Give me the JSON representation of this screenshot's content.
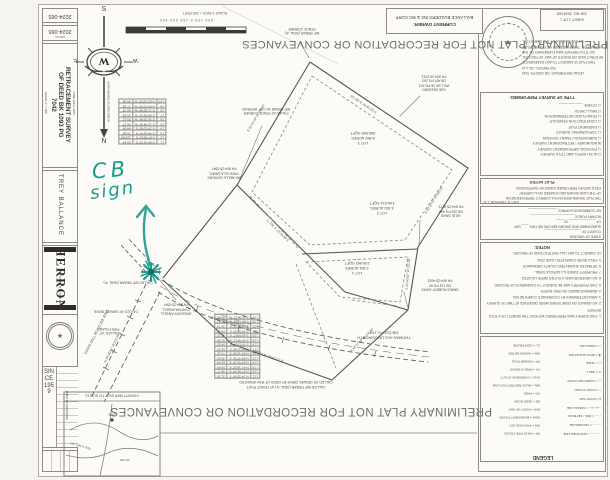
{
  "watermark": {
    "text": "PRELIMINARY PLAT NOT FOR RECORDATION OR CONVEYANCES"
  },
  "annotation": {
    "text_line1": "CB",
    "text_line2": "sign",
    "color": "#1b9b8c"
  },
  "owner": {
    "label": "CURRENT OWNER:",
    "name": "BALLANCE BUILDERS INC & WC CORP"
  },
  "titleblock": {
    "job_number": "2024-065",
    "job_label": "JOB NO.",
    "title_lines": [
      "RETRACEMENT SURVEY",
      "OF DEED BK 1093 PG",
      "7042"
    ],
    "scale_note": "SCALE: 1\" = 200'",
    "date_note": "JUNE 10TH, 2024",
    "client": "TREY BALLANCE",
    "firm": "HERRON",
    "firm_sub": "LAND SURVEYING",
    "since": "SINCE 1959",
    "revisions_heading": "TABLE OF REVISIONS",
    "seal_center": "★"
  },
  "compass": {
    "n": "N",
    "s": "S",
    "e": "E",
    "w": "W",
    "monogram": "W",
    "note": "NORTH BASED ON GRID NORTH"
  },
  "scalebar": {
    "caption": "SCALE 1 INCH = 200 FEET",
    "ticks": "200   100   0   100   200   400"
  },
  "stamp": {
    "center": "★"
  },
  "plat": {
    "lots": {
      "lot1": [
        "LOT 1",
        "2.501 ACRES",
        "108,963 SQFT"
      ],
      "lot2": [
        "LOT 2",
        "3.352 ACRES",
        "146,014 SQFT"
      ],
      "lot3": [
        "LOT 3",
        "8.852 ACRES",
        "385,598 SQFT"
      ]
    },
    "adjoiners": {
      "baldwin": [
        "SUE BALDWIN",
        "WILL BK 28 PG 202",
        "DB 467 PG 203",
        "PH 804-25-2013"
      ],
      "julie": [
        "JULIE DAVIS",
        "DB 318 PG 440",
        "PH 804-25-3173"
      ],
      "james": [
        "JAMES ROBERT DAVIS",
        "DB 132 PG 60",
        "PH 804-25-4031"
      ],
      "thomas": [
        "THOMAS HOLLINGSWORTH",
        "DB 610 PG 143"
      ],
      "ansell": [
        "GREGORY ANSELL",
        "CYNTHIA ANSELL",
        "PH 804-25-0547"
      ],
      "sowers": [
        "MICHELLE SOWERS",
        "PRISCILLA SAVES",
        "PH 804-25-0547"
      ]
    },
    "corners": {
      "fence": [
        "5/8\" REBAR (SEAL 'A')",
        "FENCE CORNER"
      ],
      "cap": [
        "FOUND AT FENCE CORNER",
        "5/8\" REBAR W/ CAP 'HERRON'"
      ],
      "called_rebar": "CALLED 5/8\" REBAR (SEAL 'A')",
      "called_drive": "CALLED 40' GRAVEL DRIVE",
      "pipe": [
        "CALLED 1/2\"",
        "PIPE FOUND"
      ]
    },
    "roads": {
      "name": "DAVIS MILL ROAD (50' R/W)",
      "drive": "EXISTING GRAVEL DRIVE"
    },
    "bearings": [
      "S 53°18'40\" E  387.55'",
      "S 30°51'10\" W  245.20'",
      "S 45°02'27\" E  301.77'",
      "S 32°20'15\" W  162.05'",
      "S 03°40'52\" W  122.18'",
      "S 44°57'38\" W  170.93'",
      "N 72°25'48\" W  208.60'",
      "N 28°40'11\" W  132.60'"
    ],
    "table_a": {
      "rows": [
        [
          "L1",
          "N 86°41'22\" E",
          "50.44'"
        ],
        [
          "L2",
          "S 67°09'51\" E",
          "120.09'"
        ],
        [
          "L3",
          "S 48°33'47\" E",
          "75.60'"
        ],
        [
          "L4",
          "S 29°10'05\" E",
          "64.05'"
        ],
        [
          "L5",
          "S 12°44'30\" W",
          "88.27'"
        ],
        [
          "L6",
          "S 35°28'56\" W",
          "55.11'"
        ],
        [
          "L7",
          "S 58°02'14\" W",
          "92.83'"
        ],
        [
          "L8",
          "S 71°55'40\" W",
          "60.78'"
        ],
        [
          "L9",
          "N 84°17'03\" W",
          "77.92'"
        ],
        [
          "L10",
          "N 62°30'25\" W",
          "49.36'"
        ]
      ]
    },
    "table_b": {
      "rows": [
        [
          "L11",
          "N 14°22'08\" E",
          "31.20'"
        ],
        [
          "L12",
          "N 27°51'44\" E",
          "46.77'"
        ],
        [
          "L13",
          "N 41°16'32\" E",
          "58.09'"
        ],
        [
          "L14",
          "N 55°03'19\" E",
          "62.44'"
        ],
        [
          "L15",
          "N 68°47'55\" E",
          "49.83'"
        ],
        [
          "L16",
          "N 82°12'06\" E",
          "73.15'"
        ],
        [
          "L17",
          "S 84°31'48\" E",
          "66.20'"
        ],
        [
          "L18",
          "S 70°18'27\" E",
          "54.92'"
        ],
        [
          "L19",
          "S 56°44'13\" E",
          "81.06'"
        ],
        [
          "L20",
          "S 43°09'57\" E",
          "47.31'"
        ],
        [
          "L21",
          "S 29°36'40\" E",
          "69.58'"
        ],
        [
          "L22",
          "S 16°02'22\" E",
          "38.74'"
        ],
        [
          "L23",
          "S 02°28'05\" E",
          "52.61'"
        ],
        [
          "L24",
          "S 11°06'12\" W",
          "44.90'"
        ]
      ]
    },
    "table_note": [
      "CALLED 5/8\" REBAR (SEAL 'A') AT FENCE POST",
      "CALLED 40' GRAVEL DRIVE BY DEED OF R/W GRANTED"
    ],
    "vicinity": {
      "title": "VICINITY MAP (NOT TO SCALE)",
      "site": "SITE",
      "road1": "KELLS MILL RD",
      "road2": "RT 606"
    }
  },
  "panel": {
    "sheet_box": [
      "SHEET 1 OF 1",
      "JOB NO. 2024-065"
    ],
    "legal": [
      "LEGAL REFERENCE: DB 1093 PG 7042",
      "TAX PARCEL: 28-1-14",
      "THIS PLAT IS SUBJECT TO ANY EASEMENTS,",
      "RESTRICTIONS OR RIGHTS OF WAY OF RECORD.",
      "NO TITLE REPORT WAS FURNISHED TO THE",
      "SURVEYOR. THIS PLAT DOES NOT CONSTITUTE",
      "A TITLE SEARCH BY THE SURVEYOR."
    ],
    "survey_type": {
      "heading": "TYPE OF SURVEY PERFORMED:",
      "items": [
        "☐  ALTA / NSPS LAND TITLE SURVEY",
        "☐  PHYSICAL IMPROVEMENT SURVEY",
        "☒  BOUNDARY / RETRACEMENT SURVEY",
        "☐  SUBDIVISION / FAMILY DIVISION",
        "☐  TOPOGRAPHIC SURVEY",
        "☐  EASEMENT PLAT",
        "☐  CONSTRUCTION STAKEOUT",
        "☐  FEMA FLOOD DETERMINATION",
        "☐  WALL CHECK",
        "☐  OTHER: ____________"
      ]
    },
    "plat_notes": {
      "heading": "PLAT NOTES",
      "lines": [
        "THE PLAT SHOWN HEREON IS A CORRECT REPRESENTATION",
        "OF THE LAND SHOWN AND IS BASED ON A CURRENT",
        "FIELD SURVEY PERFORMED UNDER MY SUPERVISION."
      ],
      "signature": "TREY R. HERRON, L.S."
    },
    "cert": [
      "STATE OF VIRGINIA",
      "COUNTY OF ____________________",
      "SUBSCRIBED AND SWORN BEFORE ME THIS ____ DAY",
      "OF ______________, 20____.",
      "NOTARY PUBLIC ________________________",
      "MY COMMISSION EXPIRES ________________"
    ],
    "notes": {
      "heading": "NOTES:",
      "lines": [
        "1. THIS SURVEY WAS PERFORMED WITHOUT THE BENEFIT OF A TITLE REPORT.",
        "2. NO GRAVES OR CEMETERIES WERE OBSERVED AT TIME OF SURVEY.",
        "3. AREA DETERMINED BY COORDINATE COMPUTATION.",
        "4. BEARINGS BASED ON GRID NORTH.",
        "5. THIS PROPERTY MAY BE SUBJECT TO EASEMENTS OF RECORD.",
        "6. NO UNDERGROUND UTILITIES WERE LOCATED.",
        "7. PROPERTY ZONED A-1 AGRICULTURAL.",
        "8. SETBACKS SHOWN PER COUNTY ORDINANCE.",
        "9. FIELD WORK COMPLETED JUNE 2024.",
        "10. SUBJECT TO ANY / ALL RESTRICTIONS OF RECORD."
      ]
    },
    "legend": {
      "heading": "LEGEND",
      "left": [
        "IPF = IRON PIPE FOUND",
        "IRS = IRON ROD SET",
        "MON = MONUMENT FOUND",
        "R/W = RIGHT OF WAY",
        "DB = DEED BOOK",
        "PG = PAGE",
        "BRL = BLDG RESTRICTION LINE",
        "OHU = OVERHEAD UTILITY",
        "FH = FIRE HYDRANT",
        "PP = POWER POLE",
        "WM = WATER METER",
        "CL = CENTERLINE"
      ],
      "right": [
        "— — — = ADJOINER LINE",
        "—··— = CENTERLINE",
        "- - - - = BRL / SETBACK",
        "—x—x— = FENCE LINE",
        "● = POINT SET",
        "○ = POINT FOUND",
        "△ = COMPUTED POINT",
        "⊙ = WELL",
        "▢ = SHED",
        "✚ = SPOT ELEVATION",
        "⌂ = DWELLING"
      ]
    }
  }
}
